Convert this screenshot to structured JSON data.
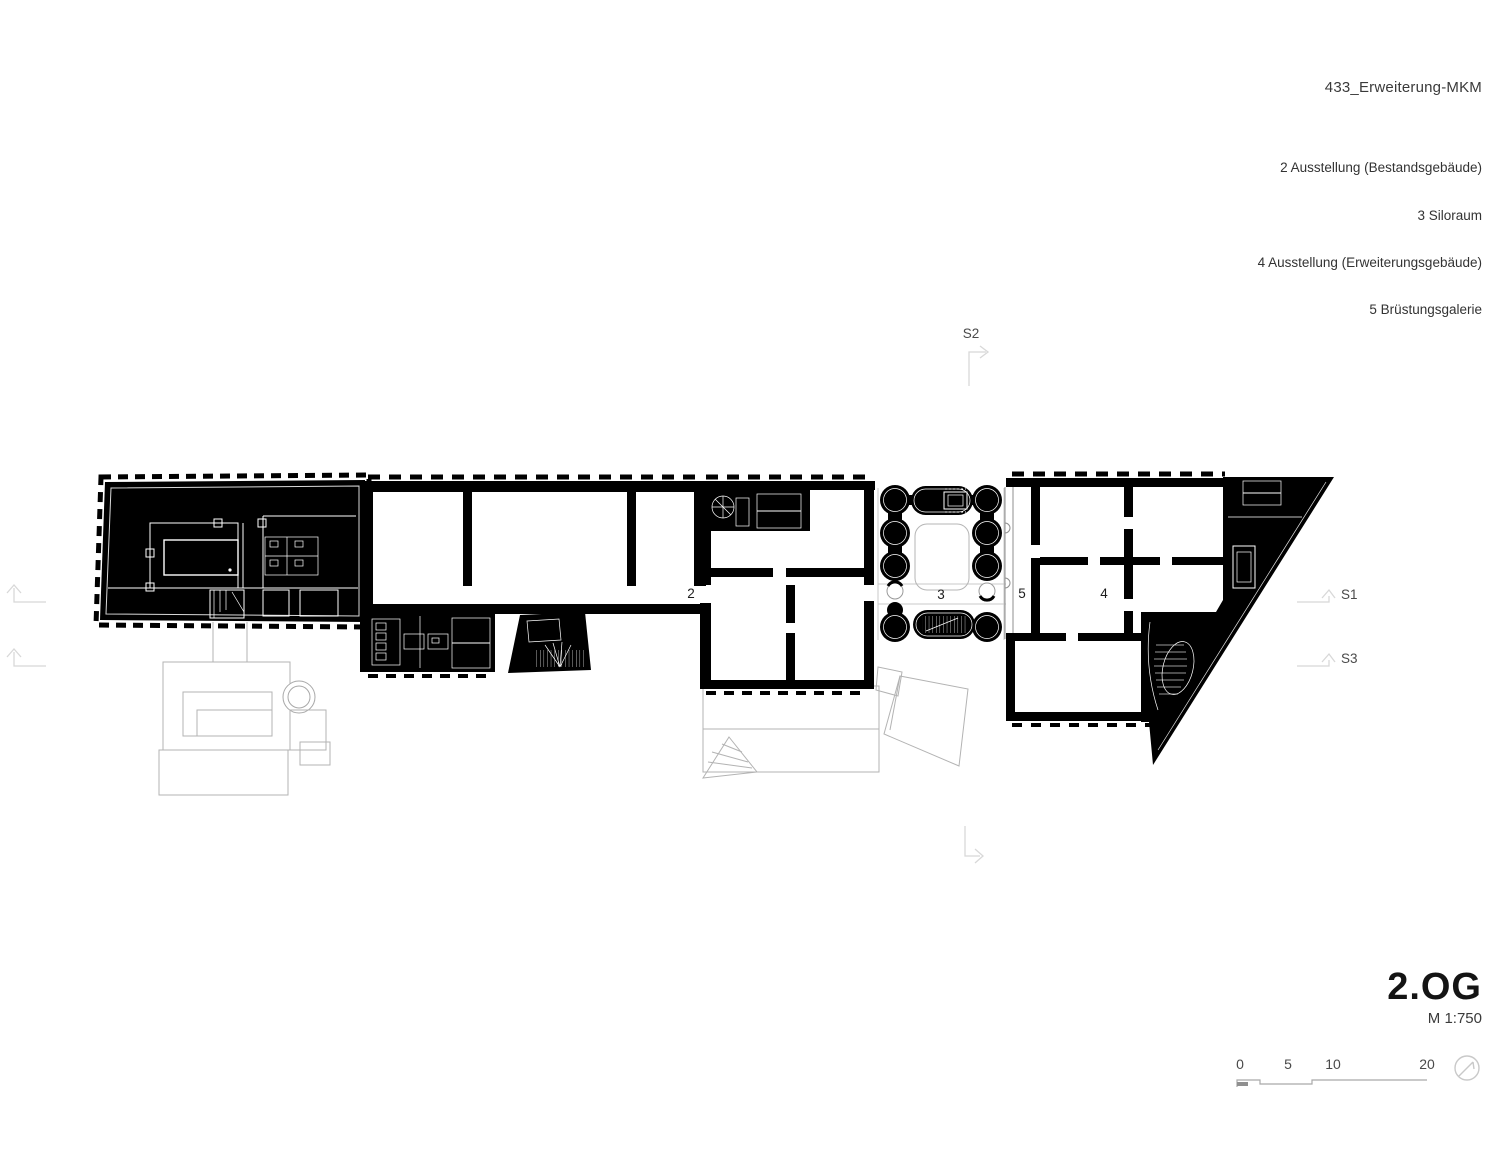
{
  "header": {
    "title": "433_Erweiterung-MKM"
  },
  "legend": {
    "items": [
      "2 Ausstellung (Bestandsgebäude)",
      "3 Siloraum",
      "4 Ausstellung (Erweiterungsgebäude)",
      "5 Brüstungsgalerie"
    ]
  },
  "plan": {
    "rooms": {
      "r2": "2",
      "r3": "3",
      "r4": "4",
      "r5": "5"
    },
    "sections": {
      "s1": "S1",
      "s2": "S2",
      "s3": "S3"
    }
  },
  "footer": {
    "floor": "2.OG",
    "scale": "M 1:750",
    "scalebar": {
      "ticks": [
        "0",
        "5",
        "10",
        "20"
      ]
    }
  },
  "colors": {
    "ink": "#000000",
    "roof": "#b3b3b3",
    "marker": "#d8d8d8"
  }
}
